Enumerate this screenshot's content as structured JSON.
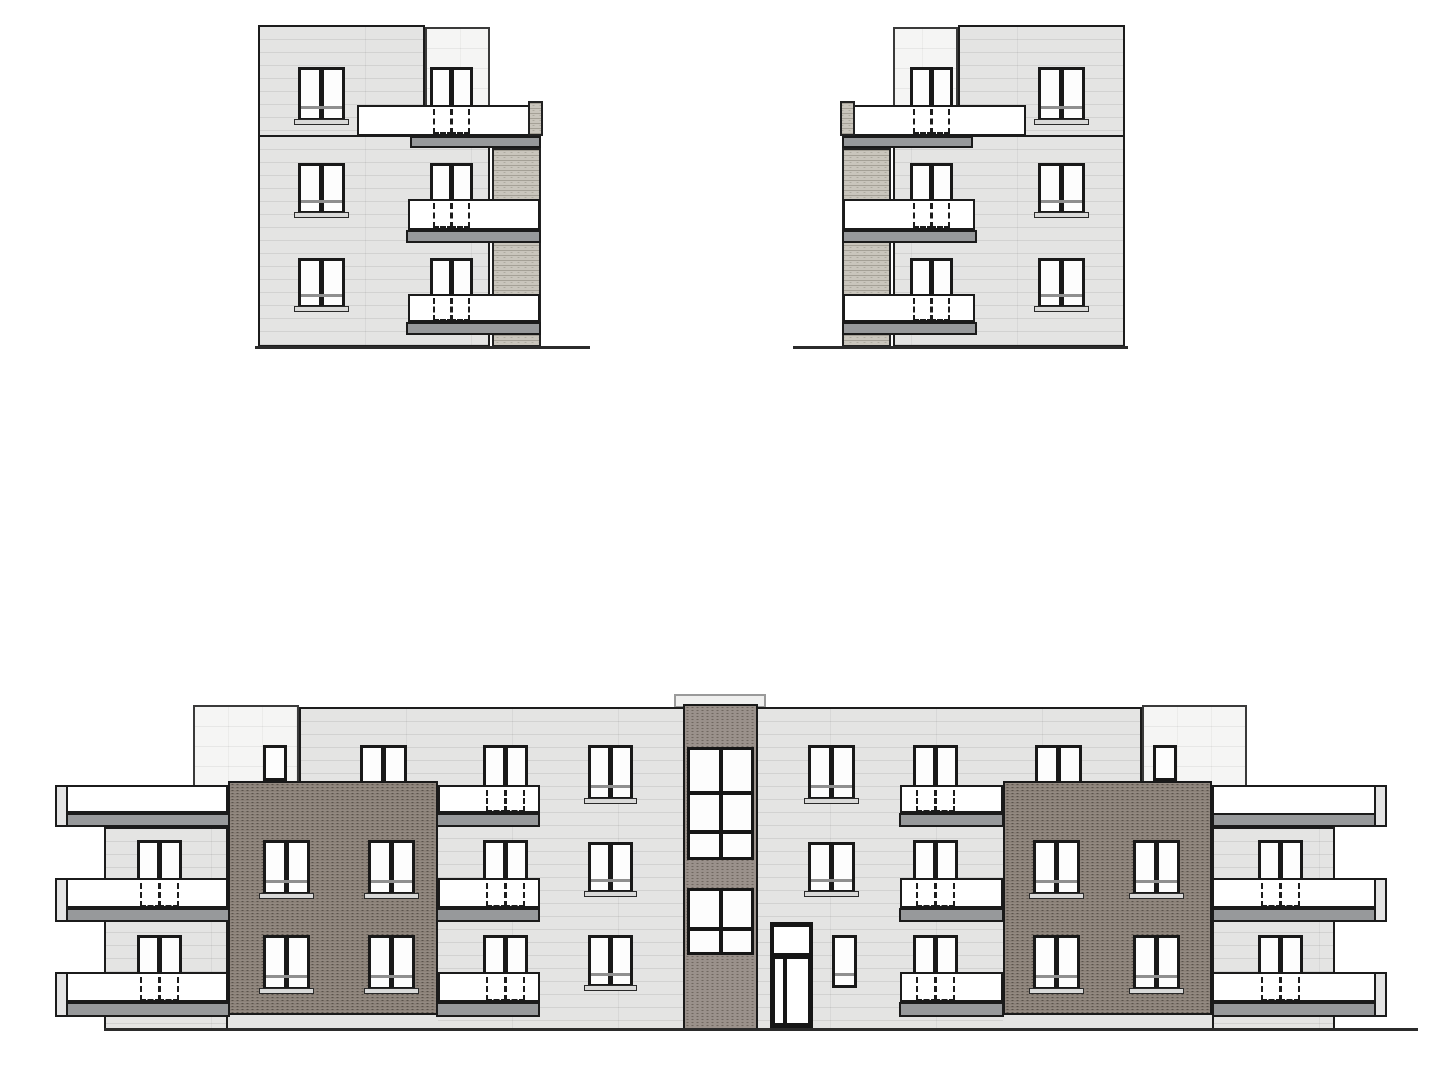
{
  "drawing": {
    "kind": "architectural-elevation-set",
    "canvas": {
      "w": 1446,
      "h": 1080
    },
    "colors": {
      "background": "#ffffff",
      "facade_gray": "#e4e4e3",
      "setback_white": "#f5f5f4",
      "brick_dark_wing": "#8b8178",
      "brick_stairwell": "#9a918b",
      "brick_light_pier": "#c9c5bc",
      "balcony_railing": "#ffffff",
      "balcony_slab": "#97999b",
      "window_frame": "#191919",
      "window_pane": "#fdfdfd",
      "outline": "#1c1c1c"
    },
    "elevations": [
      {
        "name": "side-elevation-left",
        "x": 253,
        "y": 20,
        "w": 337,
        "h": 335,
        "mirror": false,
        "elements": [
          {
            "t": "bx",
            "x": 172,
            "y": 7,
            "w": 65,
            "h": 110,
            "n": "penthouse-setback"
          },
          {
            "t": "fc",
            "x": 5,
            "y": 5,
            "w": 167,
            "h": 112,
            "n": "upper-facade"
          },
          {
            "t": "fc",
            "x": 5,
            "y": 115,
            "w": 232,
            "h": 212,
            "n": "main-facade"
          },
          {
            "t": "bl",
            "x": 239,
            "y": 128,
            "w": 49,
            "h": 199,
            "n": "brick-pier"
          },
          {
            "t": "w2",
            "x": 45,
            "y": 47,
            "w": 47,
            "h": 54,
            "m": 1,
            "s": 1,
            "n": "window"
          },
          {
            "t": "w2",
            "x": 45,
            "y": 143,
            "w": 47,
            "h": 51,
            "m": 1,
            "s": 1,
            "n": "window"
          },
          {
            "t": "w2",
            "x": 45,
            "y": 238,
            "w": 47,
            "h": 50,
            "m": 1,
            "s": 1,
            "n": "window"
          },
          {
            "t": "w2",
            "x": 177,
            "y": 47,
            "w": 43,
            "h": 41,
            "n": "balcony-door"
          },
          {
            "t": "w2",
            "x": 177,
            "y": 143,
            "w": 43,
            "h": 39,
            "n": "balcony-door"
          },
          {
            "t": "w2",
            "x": 177,
            "y": 238,
            "w": 43,
            "h": 39,
            "n": "balcony-door"
          },
          {
            "t": "rl",
            "x": 104,
            "y": 85,
            "w": 183,
            "h": 31,
            "n": "balcony-railing"
          },
          {
            "t": "rl",
            "x": 155,
            "y": 179,
            "w": 132,
            "h": 31,
            "n": "balcony-railing"
          },
          {
            "t": "rl",
            "x": 155,
            "y": 274,
            "w": 132,
            "h": 28,
            "n": "balcony-railing"
          },
          {
            "t": "bl",
            "x": 275,
            "y": 81,
            "w": 15,
            "h": 35,
            "n": "pier-cap"
          },
          {
            "t": "sb",
            "x": 157,
            "y": 116,
            "w": 131,
            "h": 12,
            "n": "balcony-slab"
          },
          {
            "t": "sb",
            "x": 153,
            "y": 210,
            "w": 135,
            "h": 13,
            "n": "balcony-slab"
          },
          {
            "t": "sb",
            "x": 153,
            "y": 302,
            "w": 135,
            "h": 13,
            "n": "balcony-slab"
          },
          {
            "t": "dh",
            "x": 177,
            "y": 89,
            "w": 43,
            "h": 25,
            "n": "balcony-door-dashed"
          },
          {
            "t": "dh",
            "x": 177,
            "y": 183,
            "w": 43,
            "h": 25,
            "n": "balcony-door-dashed"
          },
          {
            "t": "dh",
            "x": 177,
            "y": 278,
            "w": 43,
            "h": 23,
            "n": "balcony-door-dashed"
          },
          {
            "t": "gl",
            "x": 2,
            "y": 326,
            "w": 335,
            "h": 3,
            "n": "ground-line"
          }
        ]
      },
      {
        "name": "side-elevation-right",
        "x": 793,
        "y": 20,
        "w": 337,
        "h": 335,
        "mirror": true,
        "same_as": 0
      },
      {
        "name": "front-elevation",
        "x": 55,
        "y": 690,
        "w": 1370,
        "h": 348,
        "mirror": false,
        "elements": [
          {
            "t": "vt",
            "x": 619,
            "y": 4,
            "w": 92,
            "h": 14,
            "n": "roof-vent"
          },
          {
            "t": "bx",
            "x": 138,
            "y": 15,
            "w": 106,
            "h": 110,
            "n": "penthouse-setback-left"
          },
          {
            "t": "bx",
            "x": 1087,
            "y": 15,
            "w": 105,
            "h": 110,
            "n": "penthouse-setback-right"
          },
          {
            "t": "sg",
            "x": 208,
            "y": 55,
            "w": 24,
            "h": 36,
            "n": "penthouse-window-left"
          },
          {
            "t": "sg",
            "x": 1098,
            "y": 55,
            "w": 24,
            "h": 36,
            "n": "penthouse-window-right"
          },
          {
            "t": "fc",
            "x": 244,
            "y": 17,
            "w": 843,
            "h": 324,
            "n": "main-facade"
          },
          {
            "t": "w2",
            "x": 305,
            "y": 55,
            "w": 47,
            "h": 50,
            "m": 1,
            "n": "window-occluded-left"
          },
          {
            "t": "w2",
            "x": 980,
            "y": 55,
            "w": 47,
            "h": 50,
            "m": 1,
            "n": "window-occluded-right"
          },
          {
            "t": "wd",
            "x": 173,
            "y": 91,
            "w": 210,
            "h": 234,
            "n": "brick-wing-left"
          },
          {
            "t": "wd",
            "x": 948,
            "y": 91,
            "w": 209,
            "h": 234,
            "n": "brick-wing-right"
          },
          {
            "t": "st",
            "x": 173,
            "y": 325,
            "w": 210,
            "h": 16,
            "n": "plinth-left"
          },
          {
            "t": "st",
            "x": 948,
            "y": 325,
            "w": 209,
            "h": 16,
            "n": "plinth-right"
          },
          {
            "t": "fc",
            "x": 49,
            "y": 137,
            "w": 124,
            "h": 204,
            "n": "side-facade-left"
          },
          {
            "t": "fc",
            "x": 1157,
            "y": 137,
            "w": 123,
            "h": 204,
            "n": "side-facade-right"
          },
          {
            "t": "tb",
            "x": 628,
            "y": 14,
            "w": 75,
            "h": 326,
            "n": "stairwell-tower"
          },
          {
            "t": "bw",
            "x": 632,
            "y": 57,
            "w": 67,
            "h": 113,
            "rows": [
              41,
              35,
              23
            ],
            "n": "stairwell-window-upper"
          },
          {
            "t": "bw",
            "x": 632,
            "y": 198,
            "w": 67,
            "h": 67,
            "rows": [
              36,
              21
            ],
            "n": "stairwell-window-lower"
          },
          {
            "t": "w2",
            "x": 428,
            "y": 55,
            "w": 45,
            "h": 44,
            "n": "balcony-door"
          },
          {
            "t": "w2",
            "x": 533,
            "y": 55,
            "w": 45,
            "h": 55,
            "m": 1,
            "s": 1,
            "n": "window"
          },
          {
            "t": "w2",
            "x": 753,
            "y": 55,
            "w": 47,
            "h": 55,
            "m": 1,
            "s": 1,
            "n": "window"
          },
          {
            "t": "w2",
            "x": 858,
            "y": 55,
            "w": 45,
            "h": 44,
            "n": "balcony-door"
          },
          {
            "t": "w2",
            "x": 82,
            "y": 150,
            "w": 45,
            "h": 42,
            "n": "balcony-door"
          },
          {
            "t": "w2",
            "x": 208,
            "y": 150,
            "w": 47,
            "h": 55,
            "m": 1,
            "s": 1,
            "n": "window"
          },
          {
            "t": "w2",
            "x": 313,
            "y": 150,
            "w": 47,
            "h": 55,
            "m": 1,
            "s": 1,
            "n": "window"
          },
          {
            "t": "w2",
            "x": 428,
            "y": 150,
            "w": 45,
            "h": 42,
            "n": "balcony-door"
          },
          {
            "t": "w2",
            "x": 533,
            "y": 152,
            "w": 45,
            "h": 51,
            "m": 1,
            "s": 1,
            "n": "window"
          },
          {
            "t": "w2",
            "x": 753,
            "y": 152,
            "w": 47,
            "h": 51,
            "m": 1,
            "s": 1,
            "n": "window"
          },
          {
            "t": "w2",
            "x": 858,
            "y": 150,
            "w": 45,
            "h": 42,
            "n": "balcony-door"
          },
          {
            "t": "w2",
            "x": 978,
            "y": 150,
            "w": 47,
            "h": 55,
            "m": 1,
            "s": 1,
            "n": "window"
          },
          {
            "t": "w2",
            "x": 1078,
            "y": 150,
            "w": 47,
            "h": 55,
            "m": 1,
            "s": 1,
            "n": "window"
          },
          {
            "t": "w2",
            "x": 1203,
            "y": 150,
            "w": 45,
            "h": 42,
            "n": "balcony-door"
          },
          {
            "t": "w2",
            "x": 82,
            "y": 245,
            "w": 45,
            "h": 41,
            "n": "balcony-door"
          },
          {
            "t": "w2",
            "x": 208,
            "y": 245,
            "w": 47,
            "h": 55,
            "m": 1,
            "s": 1,
            "n": "window"
          },
          {
            "t": "w2",
            "x": 313,
            "y": 245,
            "w": 47,
            "h": 55,
            "m": 1,
            "s": 1,
            "n": "window"
          },
          {
            "t": "w2",
            "x": 428,
            "y": 245,
            "w": 45,
            "h": 41,
            "n": "balcony-door"
          },
          {
            "t": "w2",
            "x": 533,
            "y": 245,
            "w": 45,
            "h": 52,
            "m": 1,
            "s": 1,
            "n": "window"
          },
          {
            "t": "dr",
            "x": 715,
            "y": 232,
            "w": 43,
            "h": 106,
            "n": "entrance-door"
          },
          {
            "t": "sg",
            "x": 777,
            "y": 245,
            "w": 25,
            "h": 53,
            "m": 1,
            "n": "ground-floor-window"
          },
          {
            "t": "w2",
            "x": 858,
            "y": 245,
            "w": 45,
            "h": 41,
            "n": "balcony-door"
          },
          {
            "t": "w2",
            "x": 978,
            "y": 245,
            "w": 47,
            "h": 55,
            "m": 1,
            "s": 1,
            "n": "window"
          },
          {
            "t": "w2",
            "x": 1078,
            "y": 245,
            "w": 47,
            "h": 55,
            "m": 1,
            "s": 1,
            "n": "window"
          },
          {
            "t": "w2",
            "x": 1203,
            "y": 245,
            "w": 45,
            "h": 41,
            "n": "balcony-door"
          },
          {
            "t": "rl",
            "x": 2,
            "y": 95,
            "w": 171,
            "h": 28,
            "n": "balcony-railing"
          },
          {
            "t": "rl",
            "x": 383,
            "y": 95,
            "w": 102,
            "h": 28,
            "n": "balcony-railing"
          },
          {
            "t": "rl",
            "x": 845,
            "y": 95,
            "w": 103,
            "h": 28,
            "n": "balcony-railing"
          },
          {
            "t": "rl",
            "x": 1157,
            "y": 95,
            "w": 171,
            "h": 30,
            "n": "balcony-railing"
          },
          {
            "t": "rl",
            "x": 2,
            "y": 188,
            "w": 171,
            "h": 30,
            "n": "balcony-railing"
          },
          {
            "t": "rl",
            "x": 383,
            "y": 188,
            "w": 102,
            "h": 30,
            "n": "balcony-railing"
          },
          {
            "t": "rl",
            "x": 845,
            "y": 188,
            "w": 103,
            "h": 30,
            "n": "balcony-railing"
          },
          {
            "t": "rl",
            "x": 1157,
            "y": 188,
            "w": 171,
            "h": 30,
            "n": "balcony-railing"
          },
          {
            "t": "rl",
            "x": 2,
            "y": 282,
            "w": 171,
            "h": 30,
            "n": "balcony-railing"
          },
          {
            "t": "rl",
            "x": 383,
            "y": 282,
            "w": 102,
            "h": 30,
            "n": "balcony-railing"
          },
          {
            "t": "rl",
            "x": 845,
            "y": 282,
            "w": 103,
            "h": 30,
            "n": "balcony-railing"
          },
          {
            "t": "rl",
            "x": 1157,
            "y": 282,
            "w": 171,
            "h": 30,
            "n": "balcony-railing"
          },
          {
            "t": "sb",
            "x": 0,
            "y": 123,
            "w": 175,
            "h": 14,
            "n": "balcony-slab"
          },
          {
            "t": "sb",
            "x": 381,
            "y": 123,
            "w": 104,
            "h": 14,
            "n": "balcony-slab"
          },
          {
            "t": "sb",
            "x": 844,
            "y": 123,
            "w": 105,
            "h": 14,
            "n": "balcony-slab"
          },
          {
            "t": "sb",
            "x": 1157,
            "y": 123,
            "w": 175,
            "h": 14,
            "n": "balcony-slab"
          },
          {
            "t": "sb",
            "x": 0,
            "y": 218,
            "w": 175,
            "h": 14,
            "n": "balcony-slab"
          },
          {
            "t": "sb",
            "x": 381,
            "y": 218,
            "w": 104,
            "h": 14,
            "n": "balcony-slab"
          },
          {
            "t": "sb",
            "x": 844,
            "y": 218,
            "w": 105,
            "h": 14,
            "n": "balcony-slab"
          },
          {
            "t": "sb",
            "x": 1157,
            "y": 218,
            "w": 175,
            "h": 14,
            "n": "balcony-slab"
          },
          {
            "t": "sb",
            "x": 0,
            "y": 312,
            "w": 175,
            "h": 15,
            "n": "balcony-slab"
          },
          {
            "t": "sb",
            "x": 381,
            "y": 312,
            "w": 104,
            "h": 15,
            "n": "balcony-slab"
          },
          {
            "t": "sb",
            "x": 844,
            "y": 312,
            "w": 105,
            "h": 15,
            "n": "balcony-slab"
          },
          {
            "t": "sb",
            "x": 1157,
            "y": 312,
            "w": 175,
            "h": 15,
            "n": "balcony-slab"
          },
          {
            "t": "ps",
            "x": 0,
            "y": 95,
            "w": 13,
            "h": 42,
            "n": "balcony-post"
          },
          {
            "t": "ps",
            "x": 0,
            "y": 188,
            "w": 13,
            "h": 44,
            "n": "balcony-post"
          },
          {
            "t": "ps",
            "x": 0,
            "y": 282,
            "w": 13,
            "h": 45,
            "n": "balcony-post"
          },
          {
            "t": "ps",
            "x": 1319,
            "y": 95,
            "w": 13,
            "h": 42,
            "n": "balcony-post"
          },
          {
            "t": "ps",
            "x": 1319,
            "y": 188,
            "w": 13,
            "h": 44,
            "n": "balcony-post"
          },
          {
            "t": "ps",
            "x": 1319,
            "y": 282,
            "w": 13,
            "h": 45,
            "n": "balcony-post"
          },
          {
            "t": "dh",
            "x": 428,
            "y": 100,
            "w": 45,
            "h": 22,
            "n": "balcony-door-dashed"
          },
          {
            "t": "dh",
            "x": 858,
            "y": 100,
            "w": 45,
            "h": 22,
            "n": "balcony-door-dashed"
          },
          {
            "t": "dh",
            "x": 82,
            "y": 193,
            "w": 45,
            "h": 24,
            "n": "balcony-door-dashed"
          },
          {
            "t": "dh",
            "x": 428,
            "y": 193,
            "w": 45,
            "h": 24,
            "n": "balcony-door-dashed"
          },
          {
            "t": "dh",
            "x": 858,
            "y": 193,
            "w": 45,
            "h": 24,
            "n": "balcony-door-dashed"
          },
          {
            "t": "dh",
            "x": 1203,
            "y": 193,
            "w": 45,
            "h": 24,
            "n": "balcony-door-dashed"
          },
          {
            "t": "dh",
            "x": 82,
            "y": 287,
            "w": 45,
            "h": 24,
            "n": "balcony-door-dashed"
          },
          {
            "t": "dh",
            "x": 428,
            "y": 287,
            "w": 45,
            "h": 24,
            "n": "balcony-door-dashed"
          },
          {
            "t": "dh",
            "x": 858,
            "y": 287,
            "w": 45,
            "h": 24,
            "n": "balcony-door-dashed"
          },
          {
            "t": "dh",
            "x": 1203,
            "y": 287,
            "w": 45,
            "h": 24,
            "n": "balcony-door-dashed"
          },
          {
            "t": "gl",
            "x": 49,
            "y": 338,
            "w": 1314,
            "h": 3,
            "n": "ground-line"
          }
        ]
      }
    ]
  }
}
